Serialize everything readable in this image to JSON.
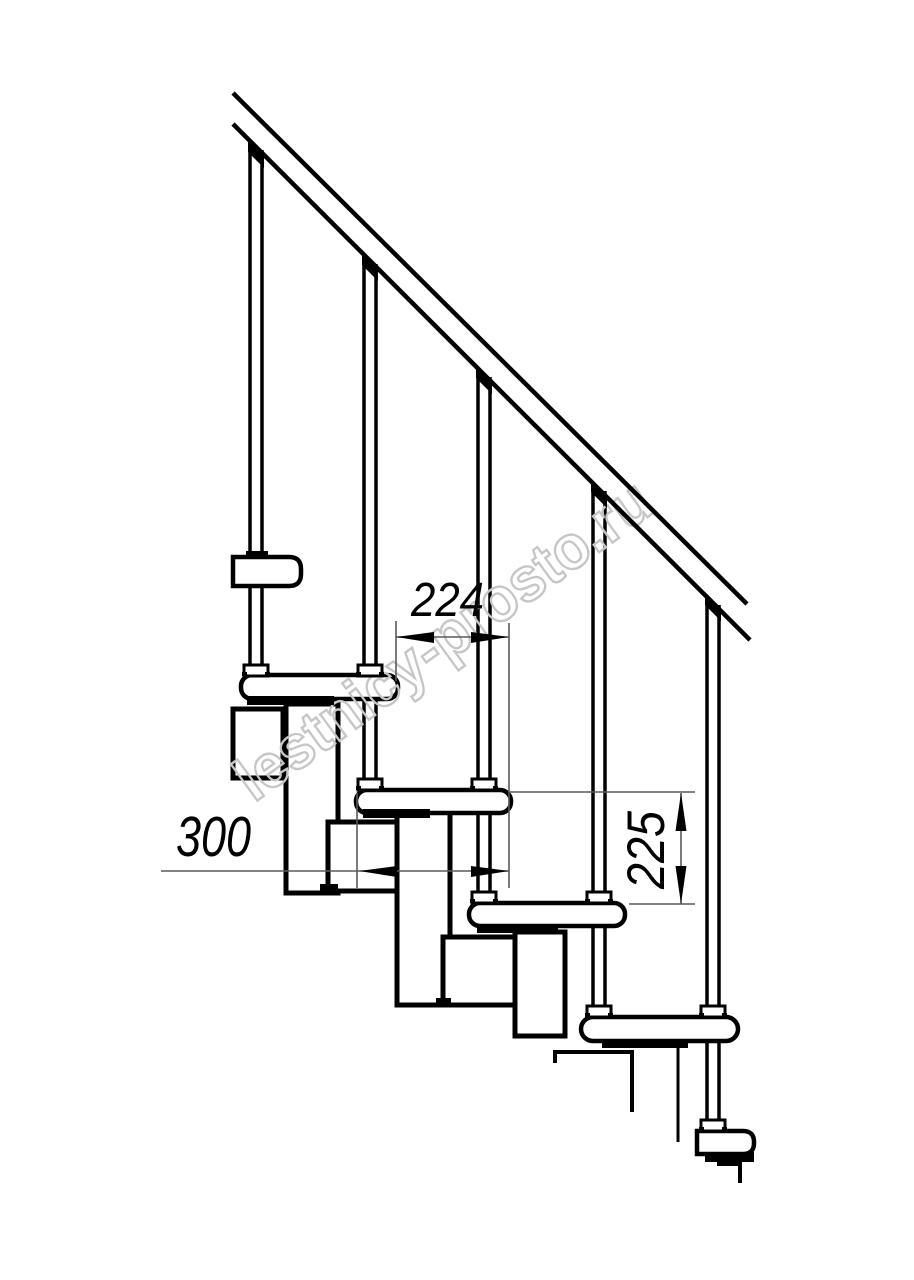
{
  "drawing": {
    "background": "#ffffff",
    "line_color": "#000000",
    "watermark": {
      "text": "lestnicy-prosto.ru",
      "color": "#c6c6c6"
    },
    "dimensions": {
      "tread_run": {
        "value": "224"
      },
      "module_length": {
        "value": "300"
      },
      "step_rise": {
        "value": "225"
      }
    }
  }
}
